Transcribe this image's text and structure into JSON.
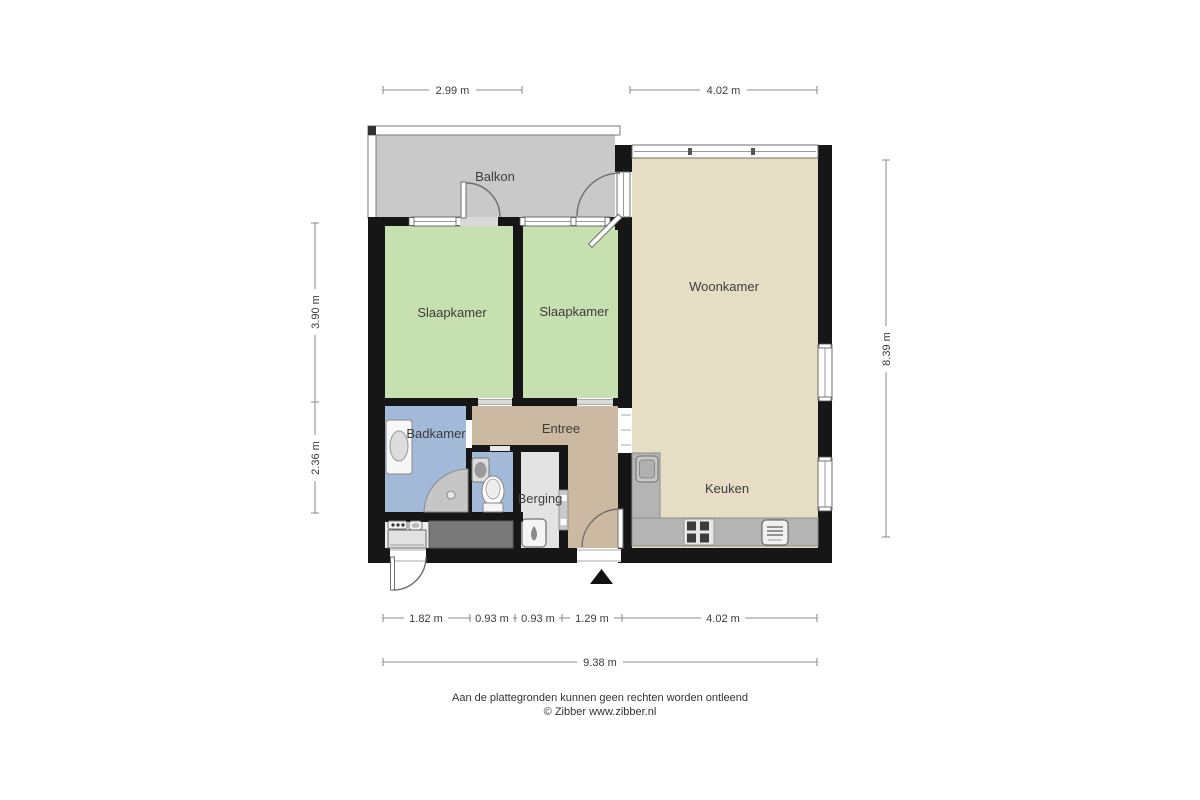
{
  "plan": {
    "rooms": {
      "balkon": {
        "label": "Balkon",
        "color": "#c9c9c9"
      },
      "slaapkamer_left": {
        "label": "Slaapkamer",
        "color": "#c6e1af"
      },
      "slaapkamer_right": {
        "label": "Slaapkamer",
        "color": "#c6e1af"
      },
      "woonkamer": {
        "label": "Woonkamer",
        "color": "#e6dec4"
      },
      "keuken": {
        "label": "Keuken",
        "color": "#e6dec4"
      },
      "entree": {
        "label": "Entree",
        "color": "#ccb9a2"
      },
      "badkamer": {
        "label": "Badkamer",
        "color": "#a3b9d8"
      },
      "berging": {
        "label": "Berging",
        "color": "#e3e3e3"
      }
    },
    "fixtures": {
      "badkamer": [
        "bathtub",
        "shower",
        "sink",
        "toilet"
      ],
      "berging": [
        "water-heater"
      ],
      "keuken": [
        "kitchen-sink",
        "stove",
        "oven"
      ],
      "utility_closet": [
        "washer-controls",
        "utility-sink",
        "washing-machine",
        "worktop"
      ]
    },
    "markers": [
      "entrance-arrow"
    ]
  },
  "dimensions": {
    "top": [
      "2.99 m",
      "4.02 m"
    ],
    "bottom": [
      "1.82 m",
      "0.93 m",
      "0.93 m",
      "1.29 m",
      "4.02 m"
    ],
    "bottom_total": "9.38 m",
    "left": [
      "3.90 m",
      "2.36 m"
    ],
    "right": [
      "8.39 m"
    ]
  },
  "footer": {
    "disclaimer": "Aan de plattegronden kunnen geen rechten worden ontleend",
    "copyright": "© Zibber www.zibber.nl"
  },
  "colors": {
    "wall": "#161616",
    "balkon": "#c9c9c9",
    "bedroom": "#c6e1af",
    "living": "#e6dec4",
    "entree": "#ccb9a2",
    "bath": "#a3b9d8",
    "storage": "#e3e3e3",
    "closet_floor": "#ededed",
    "counter": "#b4b4b4",
    "worktop": "#787878"
  }
}
